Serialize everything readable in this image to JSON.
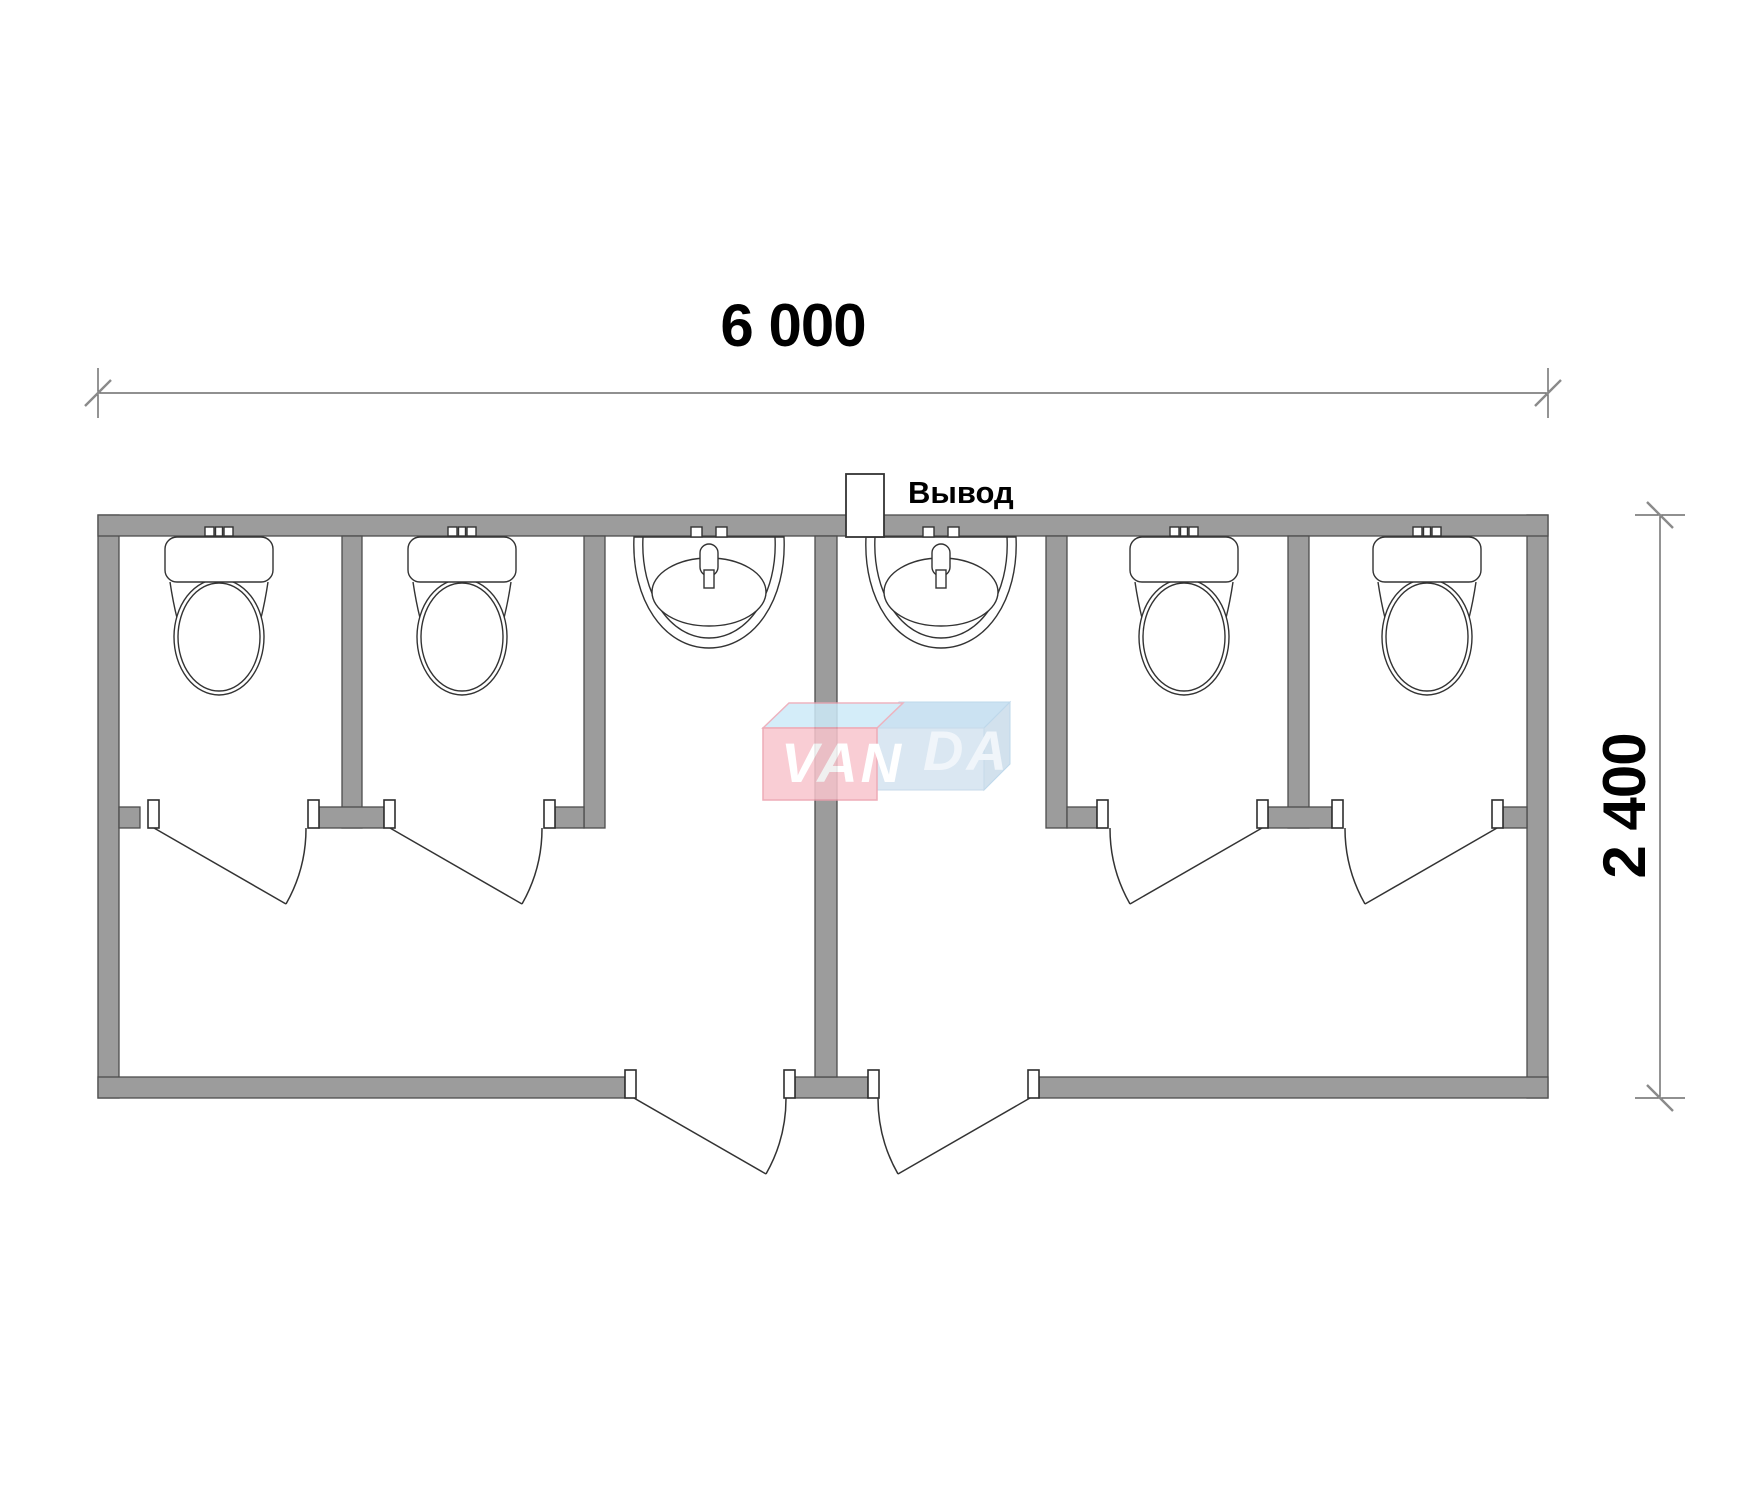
{
  "labels": {
    "width_dimension": "6 000",
    "height_dimension": "2 400",
    "outlet": "Вывод",
    "watermark_left": "VAN",
    "watermark_right": "DA"
  },
  "colors": {
    "wall_fill": "#9c9c9c",
    "wall_outline": "#4d4d4d",
    "drawing_line": "#333333",
    "watermark_pink": "#f8c5cd",
    "watermark_pink_border": "#ec9dab",
    "watermark_blue_front": "#d4e3f0",
    "watermark_blue_top": "#c3def0",
    "watermark_text": "#ffffff"
  },
  "fixtures": {
    "toilets": 4,
    "sinks": 2,
    "stall_doors": 4,
    "entry_doors": 2,
    "outlet_boxes": 1
  }
}
